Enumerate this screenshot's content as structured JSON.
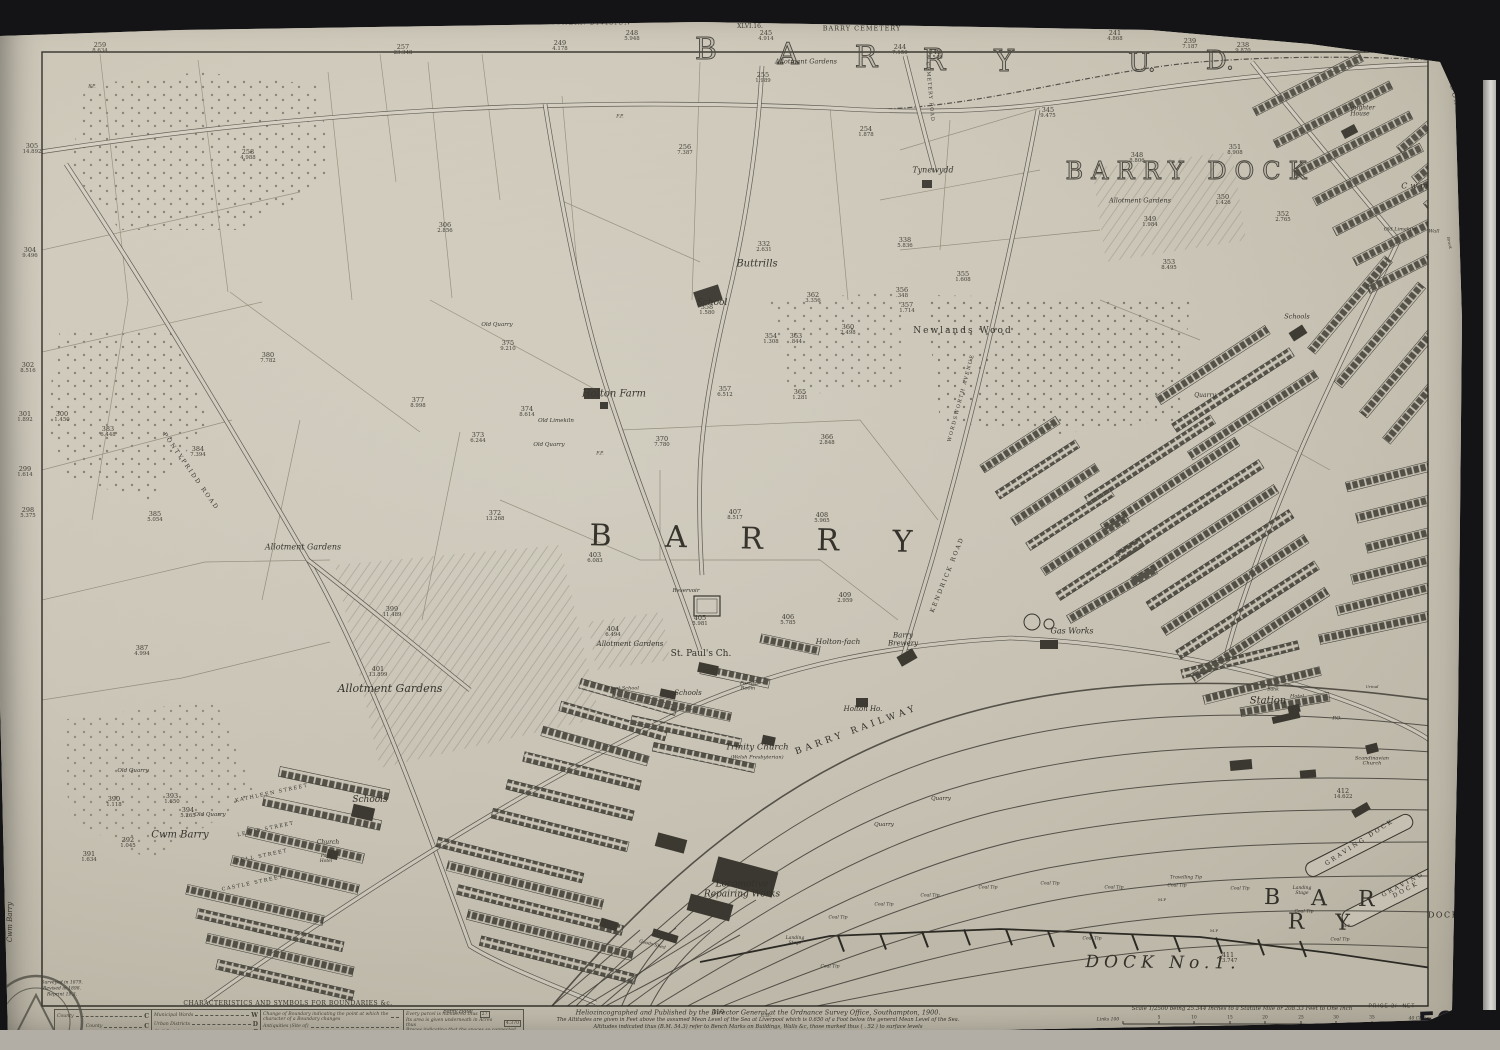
{
  "photo": {
    "background": "#141416",
    "paper": "#d2ccbd",
    "ink": "#36332c"
  },
  "margins": {
    "edition": "SECOND EDITION 1900",
    "division": "SOUTHERN DIVISION",
    "sheet_small": "XLVI.16.",
    "cemetery": "BARRY CEMETERY",
    "union": "CARDIFF UNION",
    "sheet_label": "GLAMORGAN  SHEET  L.4.",
    "adjoining_right": "CADOXTON",
    "adjoining_left": "Cwm Barry",
    "price": "PRICE 2/- NET",
    "sheet_number": "50'4",
    "survey_notes": [
      "Surveyed in 1879.",
      "Revised in 1898.",
      "Reprint 19.3."
    ]
  },
  "imprint": {
    "l1": "Heliozincographed and Published by the Director General at the Ordnance Survey Office, Southampton, 1900.",
    "l2": "The Altitudes are given in Feet above the assumed Mean Level of the Sea at Liverpool which is 0.650 of a Foot below the general Mean Level of the Sea.",
    "l3": "Altitudes indicated thus (B.M. 54.3) refer to Bench Marks on Buildings, Walls &c, those marked thus ( . 52 ) to surface levels",
    "l4": "Crown Copyright Reserved"
  },
  "scale": {
    "text": "Scale 1/2500 being 25.344 Inches to a Statute Mile or 208.33 Feet to One Inch",
    "nb": "N.B. The representation on this map of a Road, Track, or Footpath is no evidence of the existence of a right of way.",
    "links_label": "Links 100",
    "feet_label": "Feet 100",
    "chain_ticks": [
      {
        "t": "5",
        "x": 1159
      },
      {
        "t": "10",
        "x": 1194
      },
      {
        "t": "15",
        "x": 1230
      },
      {
        "t": "20",
        "x": 1265
      },
      {
        "t": "25",
        "x": 1301
      },
      {
        "t": "30",
        "x": 1336
      },
      {
        "t": "35",
        "x": 1372
      }
    ],
    "chains_end": "40 Chains",
    "feet_ticks": [
      {
        "t": "500",
        "x": 1171
      },
      {
        "t": "1000",
        "x": 1218
      },
      {
        "t": "1500",
        "x": 1266
      },
      {
        "t": "2000",
        "x": 1313
      },
      {
        "t": "2500",
        "x": 1361
      }
    ],
    "feet_end": "3000 Feet"
  },
  "legend": {
    "title": "CHARACTERISTICS AND SYMBOLS FOR BOUNDARIES &c.",
    "county": [
      [
        "County",
        "C"
      ]
    ],
    "boroughs_label": "Boroughs",
    "boroughs": [
      [
        "County",
        "C"
      ],
      [
        "Parliamentary",
        "P"
      ],
      [
        "Municipal",
        "M"
      ]
    ],
    "districts": [
      [
        "Municipal Wards",
        "W"
      ],
      [
        "Urban Districts",
        "D"
      ],
      [
        "Civil Parishes",
        "P"
      ],
      [
        "Rural Districts",
        "R"
      ]
    ],
    "notes": [
      [
        "Change of Boundary indicating the point at which the character of a Boundary changes",
        ""
      ],
      [
        "Antiquities (Site of)",
        ""
      ],
      [
        "Trigonometrical Station",
        ""
      ],
      [
        "Poor Law Unions",
        "U"
      ]
    ],
    "parcel_notes": [
      [
        "Every parcel is numbered thus",
        "27"
      ],
      [
        "Its area is given underneath in Acres thus",
        "4.370"
      ],
      [
        "Braces indicating that the spaces so connected are included in the same reference number and area",
        ""
      ],
      [
        "For other information see Characteristic Sheet",
        ""
      ]
    ]
  },
  "map": {
    "labels": [
      {
        "t": "B",
        "x": 706,
        "y": 50,
        "s": 30,
        "c": "outline"
      },
      {
        "t": "A",
        "x": 788,
        "y": 55,
        "s": 30,
        "c": "outline"
      },
      {
        "t": "R",
        "x": 866,
        "y": 58,
        "s": 30,
        "c": "outline"
      },
      {
        "t": "R",
        "x": 934,
        "y": 61,
        "s": 30,
        "c": "outline"
      },
      {
        "t": "Y",
        "x": 1004,
        "y": 62,
        "s": 30,
        "c": "outline"
      },
      {
        "t": "U.",
        "x": 1142,
        "y": 63,
        "s": 26,
        "c": "outline"
      },
      {
        "t": "D.",
        "x": 1220,
        "y": 61,
        "s": 26,
        "c": "outline"
      },
      {
        "t": "BARRY DOCK",
        "x": 1190,
        "y": 172,
        "s": 24,
        "ls": 8,
        "c": "outline",
        "nm": "district-title-barry-dock"
      },
      {
        "t": "B A R R Y",
        "x": 762,
        "y": 540,
        "s": 30,
        "ls": 22,
        "r": 1.2,
        "nm": "town-title-barry"
      },
      {
        "t": "B A R R Y",
        "x": 1325,
        "y": 911,
        "s": 22,
        "ls": 12,
        "r": 1.2,
        "nm": "docks-title-barry"
      },
      {
        "t": "DOCKS",
        "x": 1447,
        "y": 916,
        "s": 8,
        "ls": 1.5
      },
      {
        "t": "DOCK  No.1.",
        "x": 1163,
        "y": 963,
        "s": 17,
        "i": 1,
        "ls": 5,
        "r": 0.5,
        "nm": "dock-no1-label"
      },
      {
        "t": "GRAVING DOCK",
        "x": 1360,
        "y": 843,
        "s": 6,
        "ls": 2.5,
        "r": -33
      },
      {
        "t": "GRAVING DOCK",
        "x": 1405,
        "y": 888,
        "s": 6,
        "ls": 2.5,
        "r": -28
      },
      {
        "t": "BARRY  RAILWAY",
        "x": 857,
        "y": 731,
        "s": 9,
        "ls": 4,
        "r": -20,
        "nm": "barry-railway-label"
      },
      {
        "t": "Station",
        "x": 1268,
        "y": 702,
        "s": 10,
        "i": 1
      },
      {
        "t": "Tynewydd",
        "x": 933,
        "y": 171,
        "s": 8,
        "i": 1
      },
      {
        "t": "Buttrills",
        "x": 757,
        "y": 265,
        "s": 10,
        "i": 1
      },
      {
        "t": "School",
        "x": 712,
        "y": 304,
        "s": 9,
        "i": 1
      },
      {
        "t": "Newlands  Wood",
        "x": 963,
        "y": 332,
        "s": 9,
        "ls": 2
      },
      {
        "t": "Holton  Farm",
        "x": 614,
        "y": 395,
        "s": 10,
        "i": 1
      },
      {
        "t": "Old Limekiln",
        "x": 556,
        "y": 422,
        "s": 5.5,
        "i": 1
      },
      {
        "t": "Old Quarry",
        "x": 549,
        "y": 446,
        "s": 5.5,
        "i": 1
      },
      {
        "t": "Old Quarry",
        "x": 497,
        "y": 326,
        "s": 5.5,
        "i": 1
      },
      {
        "t": "Old Quarry",
        "x": 133,
        "y": 772,
        "s": 5.5,
        "i": 1
      },
      {
        "t": "Old Quarry",
        "x": 210,
        "y": 816,
        "s": 5.5,
        "i": 1
      },
      {
        "t": "Old Limekiln",
        "x": 1400,
        "y": 230,
        "s": 5,
        "i": 1
      },
      {
        "t": "Wall",
        "x": 1434,
        "y": 232,
        "s": 5,
        "i": 1
      },
      {
        "t": "Allotment Gardens",
        "x": 806,
        "y": 62,
        "s": 6.5,
        "i": 1
      },
      {
        "t": "Allotment Gardens",
        "x": 1140,
        "y": 201,
        "s": 6.5,
        "i": 1
      },
      {
        "t": "Allotment  Gardens",
        "x": 303,
        "y": 548,
        "s": 8,
        "i": 1
      },
      {
        "t": "Allotment  Gardens",
        "x": 390,
        "y": 689,
        "s": 11,
        "i": 1
      },
      {
        "t": "Allotment Gardens",
        "x": 630,
        "y": 645,
        "s": 7,
        "i": 1
      },
      {
        "t": "Cwm",
        "x": 1416,
        "y": 187,
        "s": 8,
        "i": 1,
        "ls": 3
      },
      {
        "t": "Brook",
        "x": 1449,
        "y": 243,
        "s": 4,
        "i": 1,
        "r": 78
      },
      {
        "t": "Slaughter\nHouse",
        "x": 1360,
        "y": 112,
        "s": 6,
        "i": 1
      },
      {
        "t": "Reservoir",
        "x": 686,
        "y": 592,
        "s": 5.5,
        "i": 1
      },
      {
        "t": "St. Paul's Ch.",
        "x": 701,
        "y": 655,
        "s": 9
      },
      {
        "t": "Schools",
        "x": 688,
        "y": 694,
        "s": 7,
        "i": 1
      },
      {
        "t": "Parish\nRoom",
        "x": 748,
        "y": 687,
        "s": 5,
        "i": 1
      },
      {
        "t": "Infant School",
        "x": 622,
        "y": 689,
        "s": 5,
        "i": 1
      },
      {
        "t": "Trinity Church",
        "x": 757,
        "y": 748,
        "s": 8.5,
        "i": 1
      },
      {
        "t": "(Welsh Presbyterian)",
        "x": 757,
        "y": 758,
        "s": 5,
        "i": 1
      },
      {
        "t": "Holton-fach",
        "x": 838,
        "y": 642,
        "s": 7.5,
        "i": 1
      },
      {
        "t": "Barry\nBrewery",
        "x": 903,
        "y": 640,
        "s": 7,
        "i": 1
      },
      {
        "t": "Holton Ho.",
        "x": 863,
        "y": 710,
        "s": 7,
        "i": 1
      },
      {
        "t": "Gas Works",
        "x": 1072,
        "y": 632,
        "s": 8,
        "i": 1
      },
      {
        "t": "Quarry",
        "x": 1205,
        "y": 396,
        "s": 6,
        "i": 1
      },
      {
        "t": "Quarry",
        "x": 884,
        "y": 826,
        "s": 5.5,
        "i": 1
      },
      {
        "t": "Quarry",
        "x": 941,
        "y": 800,
        "s": 5.5,
        "i": 1
      },
      {
        "t": "Cwm  Barry",
        "x": 180,
        "y": 836,
        "s": 10,
        "i": 1
      },
      {
        "t": "Schools",
        "x": 370,
        "y": 801,
        "s": 9,
        "i": 1
      },
      {
        "t": "Schools",
        "x": 1297,
        "y": 317,
        "s": 6.5,
        "i": 1
      },
      {
        "t": "Church",
        "x": 328,
        "y": 843,
        "s": 6,
        "i": 1
      },
      {
        "t": "Park\nHotel",
        "x": 326,
        "y": 860,
        "s": 4.5,
        "i": 1
      },
      {
        "t": "KATHLEEN STREET",
        "x": 272,
        "y": 794,
        "s": 5,
        "ls": 1.5,
        "r": -12
      },
      {
        "t": "LEWIS STREET",
        "x": 266,
        "y": 830,
        "s": 5,
        "ls": 1.5,
        "r": -12
      },
      {
        "t": "BELL STREET",
        "x": 262,
        "y": 857,
        "s": 5,
        "ls": 1.5,
        "r": -12
      },
      {
        "t": "CASTLE STREET",
        "x": 253,
        "y": 884,
        "s": 5,
        "ls": 1.5,
        "r": -12
      },
      {
        "t": "PONTYPRIDD  ROAD",
        "x": 190,
        "y": 472,
        "s": 6,
        "ls": 2,
        "r": 55
      },
      {
        "t": "KENDRICK  ROAD",
        "x": 948,
        "y": 575,
        "s": 6,
        "ls": 2,
        "r": -68
      },
      {
        "t": "WORDSWORTH  AVENUE",
        "x": 962,
        "y": 398,
        "s": 5,
        "ls": 1.5,
        "r": -75
      },
      {
        "t": "CEMETERY  ROAD",
        "x": 929,
        "y": 92,
        "s": 5,
        "ls": 1,
        "r": 85
      },
      {
        "t": "Locomotive\nRepairing Works",
        "x": 742,
        "y": 890,
        "s": 9,
        "i": 1
      },
      {
        "t": "Goods Shed",
        "x": 652,
        "y": 946,
        "s": 4.5,
        "i": 1,
        "r": 15
      },
      {
        "t": "Landing\nStage",
        "x": 795,
        "y": 942,
        "s": 4.5,
        "i": 1
      },
      {
        "t": "Landing\nStage",
        "x": 1302,
        "y": 892,
        "s": 4.5,
        "i": 1
      },
      {
        "t": "Travelling Tip",
        "x": 1186,
        "y": 879,
        "s": 4.5,
        "i": 1
      },
      {
        "t": "Coal Tip",
        "x": 838,
        "y": 919,
        "s": 4.5,
        "i": 1
      },
      {
        "t": "Coal Tip",
        "x": 884,
        "y": 906,
        "s": 4.5,
        "i": 1
      },
      {
        "t": "Coal Tip",
        "x": 930,
        "y": 897,
        "s": 4.5,
        "i": 1
      },
      {
        "t": "Coal Tip",
        "x": 988,
        "y": 889,
        "s": 4.5,
        "i": 1
      },
      {
        "t": "Coal Tip",
        "x": 1050,
        "y": 885,
        "s": 4.5,
        "i": 1
      },
      {
        "t": "Coal Tip",
        "x": 1114,
        "y": 889,
        "s": 4.5,
        "i": 1
      },
      {
        "t": "Coal Tip",
        "x": 1177,
        "y": 887,
        "s": 4.5,
        "i": 1
      },
      {
        "t": "Coal Tip",
        "x": 1240,
        "y": 890,
        "s": 4.5,
        "i": 1
      },
      {
        "t": "Coal Tip",
        "x": 1304,
        "y": 913,
        "s": 4.5,
        "i": 1
      },
      {
        "t": "Coal Tip",
        "x": 1340,
        "y": 941,
        "s": 4.5,
        "i": 1
      },
      {
        "t": "Coal Tip",
        "x": 830,
        "y": 968,
        "s": 4.5,
        "i": 1
      },
      {
        "t": "Coal Tip",
        "x": 1092,
        "y": 940,
        "s": 4.5,
        "i": 1
      },
      {
        "t": "M.P",
        "x": 1162,
        "y": 900,
        "s": 4
      },
      {
        "t": "M.P",
        "x": 1214,
        "y": 931,
        "s": 4
      },
      {
        "t": "M.P",
        "x": 1346,
        "y": 926,
        "s": 4
      },
      {
        "t": "Barry Hotel",
        "x": 458,
        "y": 1012,
        "s": 5,
        "i": 1
      },
      {
        "t": "Hotel",
        "x": 1297,
        "y": 697,
        "s": 5,
        "i": 1
      },
      {
        "t": "Bank",
        "x": 1273,
        "y": 691,
        "s": 4.5,
        "i": 1
      },
      {
        "t": "P.O.",
        "x": 1337,
        "y": 719,
        "s": 5,
        "i": 1
      },
      {
        "t": "Urinal",
        "x": 1372,
        "y": 687,
        "s": 4,
        "i": 1
      },
      {
        "t": "Scandinavian\nChurch",
        "x": 1372,
        "y": 762,
        "s": 5,
        "i": 1
      },
      {
        "t": "F.P.",
        "x": 92,
        "y": 88,
        "s": 4.5,
        "i": 1
      },
      {
        "t": "F.P.",
        "x": 620,
        "y": 118,
        "s": 4.5,
        "i": 1
      },
      {
        "t": "F.P.",
        "x": 600,
        "y": 455,
        "s": 4.5,
        "i": 1
      },
      {
        "t": "L.B.",
        "x": 766,
        "y": 1016,
        "s": 5
      }
    ],
    "parcels": [
      [
        "259",
        "8.634",
        100,
        48
      ],
      [
        "257",
        "23.348",
        403,
        50
      ],
      [
        "249",
        "4.178",
        560,
        46
      ],
      [
        "248",
        "5.948",
        632,
        36
      ],
      [
        "245",
        "4.914",
        766,
        36
      ],
      [
        "244",
        "7.150",
        900,
        50
      ],
      [
        "243",
        "8.549",
        935,
        55
      ],
      [
        "241",
        "4.868",
        1115,
        36
      ],
      [
        "239",
        "7.187",
        1190,
        44
      ],
      [
        "238",
        "9.870",
        1243,
        48
      ],
      [
        "255",
        "1.989",
        763,
        78
      ],
      [
        "254",
        "1.878",
        866,
        132
      ],
      [
        "256",
        "7.387",
        685,
        150
      ],
      [
        "258",
        "4.988",
        248,
        155
      ],
      [
        "306",
        "2.856",
        445,
        228
      ],
      [
        "305",
        "14.892",
        32,
        149
      ],
      [
        "304",
        "9.496",
        30,
        253
      ],
      [
        "302",
        "8.516",
        28,
        368
      ],
      [
        "301",
        "1.892",
        25,
        417
      ],
      [
        "300",
        "1.450",
        62,
        417
      ],
      [
        "299",
        "1.614",
        25,
        472
      ],
      [
        "298",
        "5.375",
        28,
        513
      ],
      [
        "383",
        "6.448",
        108,
        432
      ],
      [
        "384",
        "7.394",
        198,
        452
      ],
      [
        "385",
        "5.054",
        155,
        517
      ],
      [
        "345",
        "9.475",
        1048,
        113
      ],
      [
        "348",
        "8.806",
        1137,
        158
      ],
      [
        "351",
        "8.908",
        1235,
        150
      ],
      [
        "350",
        "1.426",
        1223,
        200
      ],
      [
        "352",
        "2.765",
        1283,
        217
      ],
      [
        "349",
        "1.984",
        1150,
        222
      ],
      [
        "353",
        "8.495",
        1169,
        265
      ],
      [
        "332",
        "2.631",
        764,
        247
      ],
      [
        "338",
        "5.836",
        905,
        243
      ],
      [
        "358",
        "1.580",
        707,
        310
      ],
      [
        "362",
        "3.356",
        813,
        298
      ],
      [
        "356",
        ".348",
        902,
        293
      ],
      [
        "357",
        "1.714",
        907,
        308
      ],
      [
        "355",
        "1.608",
        963,
        277
      ],
      [
        "354",
        "1.308",
        771,
        339
      ],
      [
        "363",
        ".844",
        796,
        339
      ],
      [
        "360",
        "2.498",
        848,
        330
      ],
      [
        "365",
        "1.281",
        800,
        395
      ],
      [
        "366",
        "2.848",
        827,
        440
      ],
      [
        "357",
        "6.512",
        725,
        392
      ],
      [
        "370",
        "7.780",
        662,
        442
      ],
      [
        "372",
        "13.268",
        495,
        516
      ],
      [
        "373",
        "6.244",
        478,
        438
      ],
      [
        "374",
        "8.614",
        527,
        412
      ],
      [
        "377",
        "8.998",
        418,
        403
      ],
      [
        "375",
        "9.210",
        508,
        346
      ],
      [
        "380",
        "7.782",
        268,
        358
      ],
      [
        "387",
        "4.994",
        142,
        651
      ],
      [
        "407",
        "8.517",
        735,
        515
      ],
      [
        "408",
        "5.965",
        822,
        518
      ],
      [
        "403",
        "6.083",
        595,
        558
      ],
      [
        "404",
        "6.494",
        613,
        632
      ],
      [
        "405",
        "5.981",
        700,
        621
      ],
      [
        "406",
        "5.785",
        788,
        620
      ],
      [
        "409",
        "2.959",
        845,
        598
      ],
      [
        "399",
        "11.489",
        392,
        612
      ],
      [
        "401",
        "13.899",
        378,
        672
      ],
      [
        "412",
        "14.622",
        1343,
        794
      ],
      [
        "411",
        "73.747",
        1228,
        958
      ],
      [
        "410",
        "",
        718,
        1012
      ],
      [
        "390",
        "1.118",
        114,
        802
      ],
      [
        "393",
        "1.650",
        172,
        799
      ],
      [
        "394",
        "5.265",
        188,
        813
      ],
      [
        "392",
        "1.045",
        128,
        843
      ],
      [
        "391",
        "1.634",
        89,
        857
      ]
    ]
  }
}
